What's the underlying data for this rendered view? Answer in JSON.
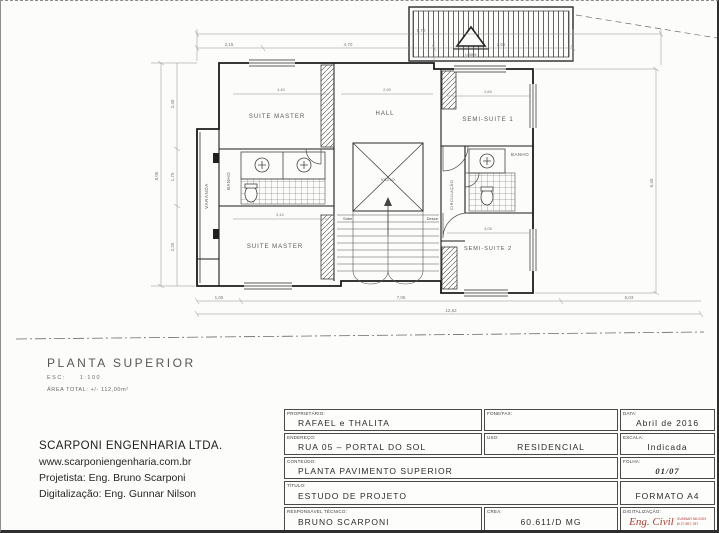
{
  "plan": {
    "caption": {
      "title": "PLANTA SUPERIOR",
      "scale_label": "ESC:",
      "scale_value": "1:100",
      "area_note": "ÁREA TOTAL: +/- 112,00m²"
    },
    "rooms": {
      "suite_master_top": "SUITE MASTER",
      "suite_master_bottom": "SUITE MASTER",
      "hall": "HALL",
      "semi_suite_1": "SEMI-SUITE 1",
      "semi_suite_2": "SEMI-SUITE 2",
      "banho_left": "BANHO",
      "banho_right": "BANHO",
      "varanda": "VARANDA",
      "circulacao": "CIRCULAÇÃO",
      "vazio": "VAZIO",
      "stair_up": "Sobe",
      "stair_down": "Desce"
    },
    "dimensions": {
      "top_total": "8,70",
      "top_a": "2,15",
      "top_b": "4,70",
      "top_c": "2,65",
      "left_total": "8,05",
      "left_a": "2,40",
      "left_b": "1,70",
      "left_c": "2,25",
      "right_total": "6,40",
      "bottom_a": "1,05",
      "bottom_b": "7,05",
      "bottom_c": "5,03",
      "bottom_total": "12,62",
      "suite_master_top_w": "4,40",
      "hall_w": "2,90",
      "semi_suite_1_w": "2,60",
      "semi_suite_2_w": "3,05",
      "suite_master_bottom_w": "3,10",
      "roof_slope": "i=30%"
    }
  },
  "company": {
    "name": "SCARPONI ENGENHARIA LTDA.",
    "website": "www.scarponiengenharia.com.br",
    "designer": "Projetista: Eng. Bruno Scarponi",
    "digitization": "Digitalização: Eng. Gunnar Nilson"
  },
  "title_block": {
    "owner": {
      "label": "PROPRIETÁRIO:",
      "value": "RAFAEL e THALITA"
    },
    "phone": {
      "label": "FONE/FAX:",
      "value": ""
    },
    "date": {
      "label": "DATA:",
      "value": "Abril de 2016"
    },
    "address": {
      "label": "ENDEREÇO:",
      "value": "RUA 05 – PORTAL DO SOL"
    },
    "use": {
      "label": "USO:",
      "value": "RESIDENCIAL"
    },
    "scale": {
      "label": "ESCALA:",
      "value": "Indicada"
    },
    "content": {
      "label": "CONTEÚDO:",
      "value": "PLANTA PAVIMENTO SUPERIOR"
    },
    "sheet": {
      "label": "FOLHA:",
      "value": "01/07"
    },
    "doc_title": {
      "label": "TÍTULO:",
      "value": "ESTUDO DE PROJETO"
    },
    "format": {
      "value": "FORMATO A4"
    },
    "responsible": {
      "label": "RESPONSÁVEL TÉCNICO:",
      "value": "BRUNO SCARPONI"
    },
    "crea": {
      "label": "CREA:",
      "value": "60.611/D MG"
    },
    "digitization": {
      "label": "DIGITALIZAÇÃO:",
      "stamp": "Eng. Civil",
      "stamp_line1": "GUNNAR NILSON",
      "stamp_line2": "M 27.897-787"
    },
    "stamp_color": "#b03a2e"
  }
}
